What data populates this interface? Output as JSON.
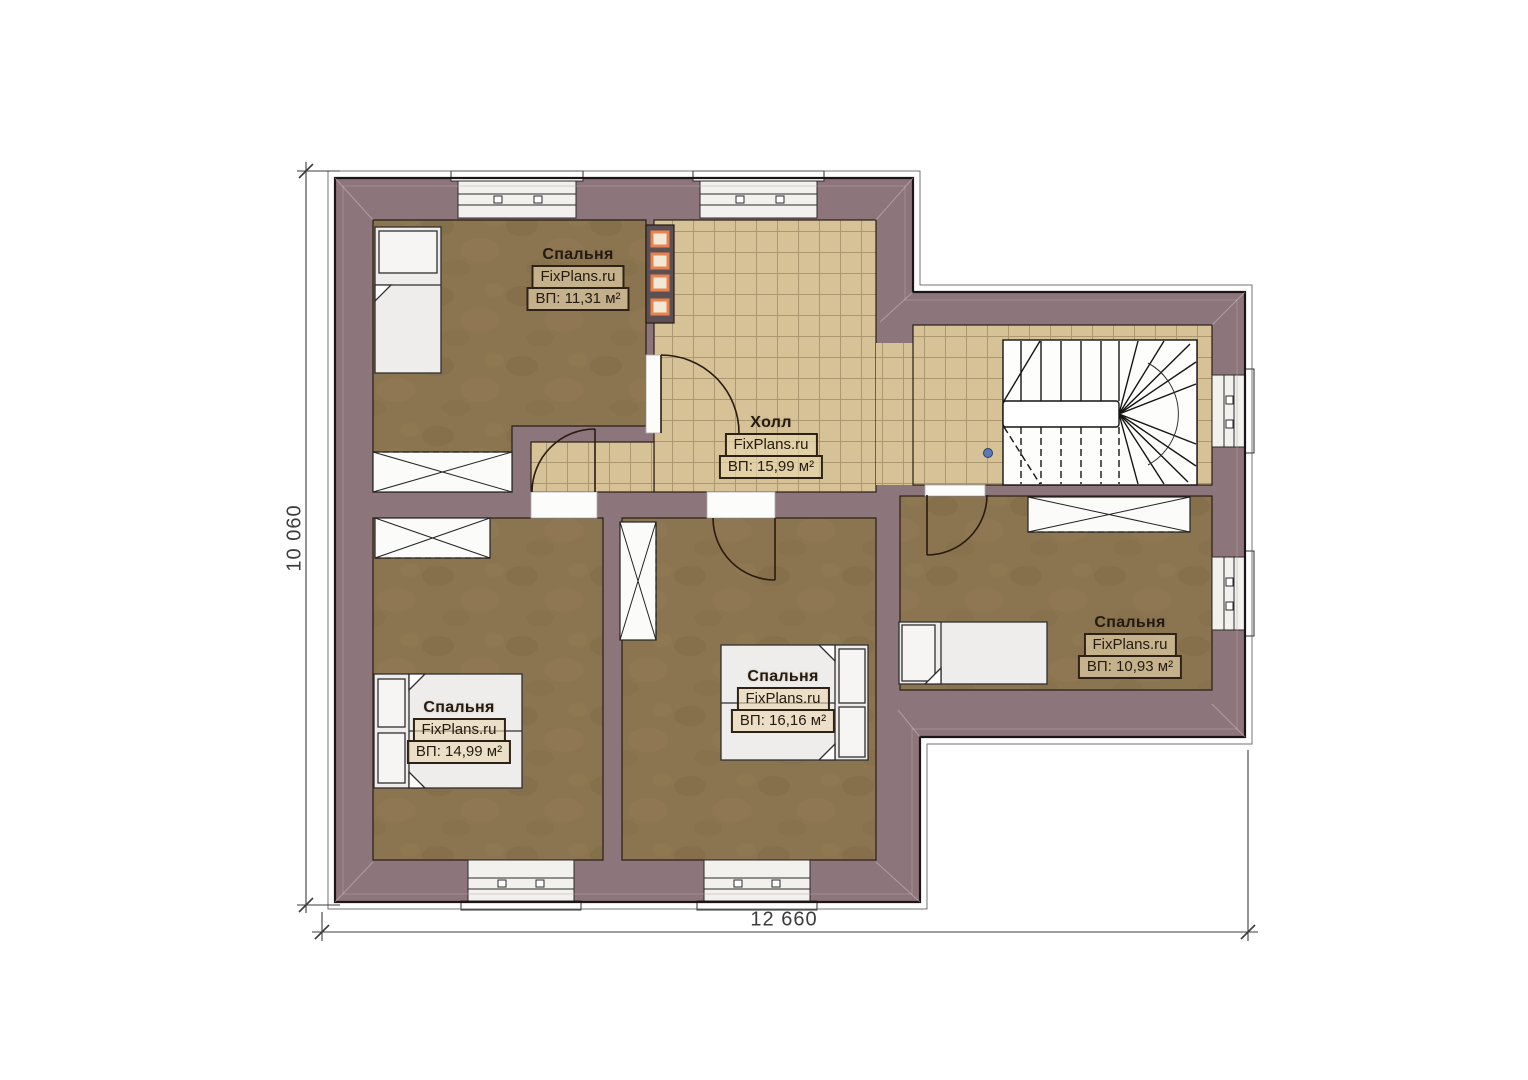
{
  "plan": {
    "title": "Floor plan — second level",
    "brand": "FixPlans.ru",
    "rooms": [
      {
        "id": "bedroom-top-left",
        "name": "Спальня",
        "watermark": "FixPlans.ru",
        "area": "ВП: 11,31 м²"
      },
      {
        "id": "hall",
        "name": "Холл",
        "watermark": "FixPlans.ru",
        "area": "ВП: 15,99 м²"
      },
      {
        "id": "bedroom-bottom-left",
        "name": "Спальня",
        "watermark": "FixPlans.ru",
        "area": "ВП: 14,99 м²"
      },
      {
        "id": "bedroom-middle",
        "name": "Спальня",
        "watermark": "FixPlans.ru",
        "area": "ВП: 16,16 м²"
      },
      {
        "id": "bedroom-right",
        "name": "Спальня",
        "watermark": "FixPlans.ru",
        "area": "ВП: 10,93 м²"
      }
    ],
    "dimensions": {
      "width_label": "12 660",
      "height_label": "10 060"
    },
    "colors": {
      "wall": "#8c757b",
      "outline": "#1c1416",
      "floor_wood": "#8b7450",
      "floor_tile": "#d7c297",
      "tile_grid": "#9c8962",
      "fixture_white": "#f2f1ee",
      "flue_accent": "#e8834f",
      "marker_dot": "#5b7ab5",
      "dim_line": "#3c3c3c"
    }
  }
}
